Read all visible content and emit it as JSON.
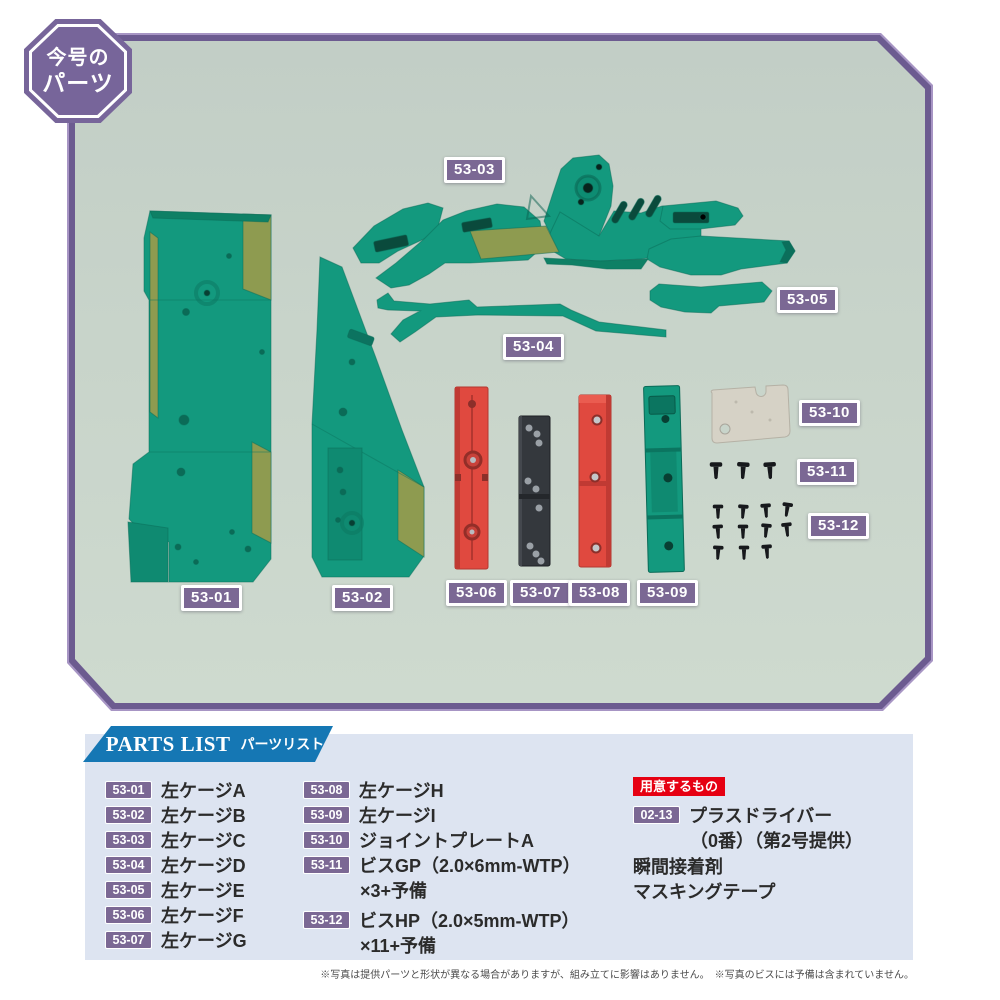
{
  "colors": {
    "frame_purple": "#6c5b90",
    "label_purple": "#7b6894",
    "banner_blue": "#1577b4",
    "prepare_red": "#e60012",
    "panel_blue": "#dde4f1",
    "photo_bg": "#c8d4ca",
    "part_teal": "#13997e",
    "part_olive": "#8e9b50",
    "part_red": "#e0493f",
    "part_black": "#34383d",
    "part_plate": "#d6d2c6"
  },
  "issue_badge": {
    "line1": "今号の",
    "line2": "パーツ"
  },
  "photo": {
    "labels": [
      {
        "text": "53-03"
      },
      {
        "text": "53-05"
      },
      {
        "text": "53-04"
      },
      {
        "text": "53-10"
      },
      {
        "text": "53-11"
      },
      {
        "text": "53-12"
      },
      {
        "text": "53-01"
      },
      {
        "text": "53-02"
      },
      {
        "text": "53-06"
      },
      {
        "text": "53-07"
      },
      {
        "text": "53-08"
      },
      {
        "text": "53-09"
      }
    ]
  },
  "parts_list": {
    "title_en": "PARTS LIST",
    "title_ja": "パーツリスト",
    "items_col1": [
      {
        "code": "53-01",
        "name": "左ケージA"
      },
      {
        "code": "53-02",
        "name": "左ケージB"
      },
      {
        "code": "53-03",
        "name": "左ケージC"
      },
      {
        "code": "53-04",
        "name": "左ケージD"
      },
      {
        "code": "53-05",
        "name": "左ケージE"
      },
      {
        "code": "53-06",
        "name": "左ケージF"
      },
      {
        "code": "53-07",
        "name": "左ケージG"
      }
    ],
    "items_col2": [
      {
        "code": "53-08",
        "name": "左ケージH"
      },
      {
        "code": "53-09",
        "name": "左ケージI"
      },
      {
        "code": "53-10",
        "name": "ジョイントプレートA"
      },
      {
        "code": "53-11",
        "name": "ビスGP（2.0×6mm-WTP）",
        "name2": "×3+予備"
      },
      {
        "code": "53-12",
        "name": "ビスHP（2.0×5mm-WTP）",
        "name2": "×11+予備"
      }
    ],
    "prepare": {
      "header": "用意するもの",
      "item_code": "02-13",
      "item_name": "プラスドライバー",
      "item_name2": "（0番）（第2号提供）",
      "extra1": "瞬間接着剤",
      "extra2": "マスキングテープ"
    }
  },
  "footnote": "※写真は提供パーツと形状が異なる場合がありますが、組み立てに影響はありません。　※写真のビスには予備は含まれていません。"
}
